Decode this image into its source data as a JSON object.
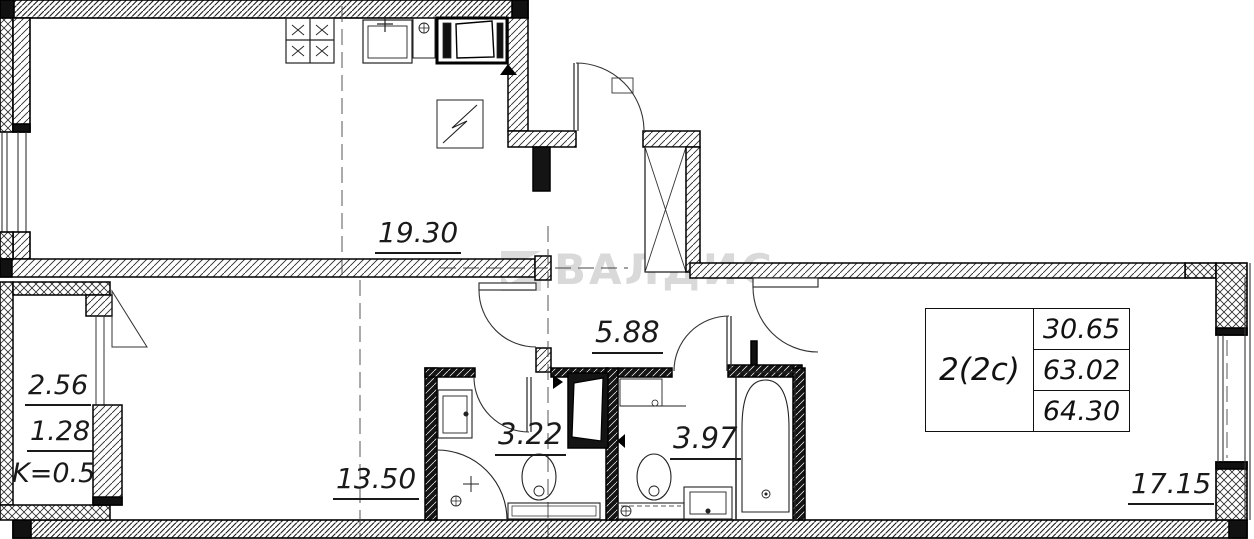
{
  "watermark": {
    "text": "ВАЛДИС"
  },
  "plan": {
    "unit_label": "2(2c)",
    "areas_table": {
      "living": "30.65",
      "area": "63.02",
      "total": "64.30"
    },
    "rooms": {
      "kitchen_living": "19.30",
      "hall": "5.88",
      "bathroom_1": "3.22",
      "bathroom_2": "3.97",
      "bedroom": "13.50",
      "living_room": "17.15",
      "balcony_area": "2.56",
      "balcony_reduced": "1.28",
      "balcony_coeff": "K=0.5"
    }
  },
  "colors": {
    "line": "#111111",
    "wall_fill": "#ffffff",
    "watermark": "#d9d9d9",
    "background": "#ffffff"
  }
}
